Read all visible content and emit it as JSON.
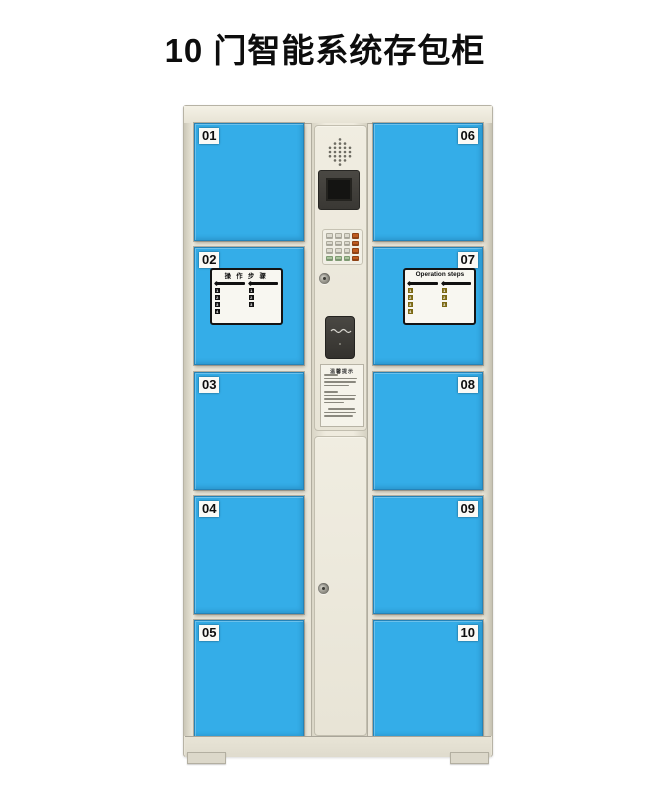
{
  "title": "10 门智能系统存包柜",
  "colors": {
    "door-blue": "#34ADE8",
    "body": "#E9E5D8",
    "key-grey": "#DCDACE",
    "key-orange": "#BF5B1F",
    "key-green": "#A9C49C"
  },
  "doors_left": [
    "01",
    "02",
    "03",
    "04",
    "05"
  ],
  "doors_right": [
    "06",
    "07",
    "08",
    "09",
    "10"
  ],
  "sticker_cn": {
    "title": "操 作 步 骤",
    "col1_steps": [
      "1",
      "2",
      "3",
      "4"
    ],
    "col2_steps": [
      "1",
      "2",
      "3"
    ]
  },
  "sticker_en": {
    "title": "Operation steps",
    "col1_steps": [
      "1",
      "2",
      "3",
      "4"
    ],
    "col2_steps": [
      "1",
      "2",
      "3"
    ]
  },
  "notice": {
    "title": "温馨提示"
  }
}
